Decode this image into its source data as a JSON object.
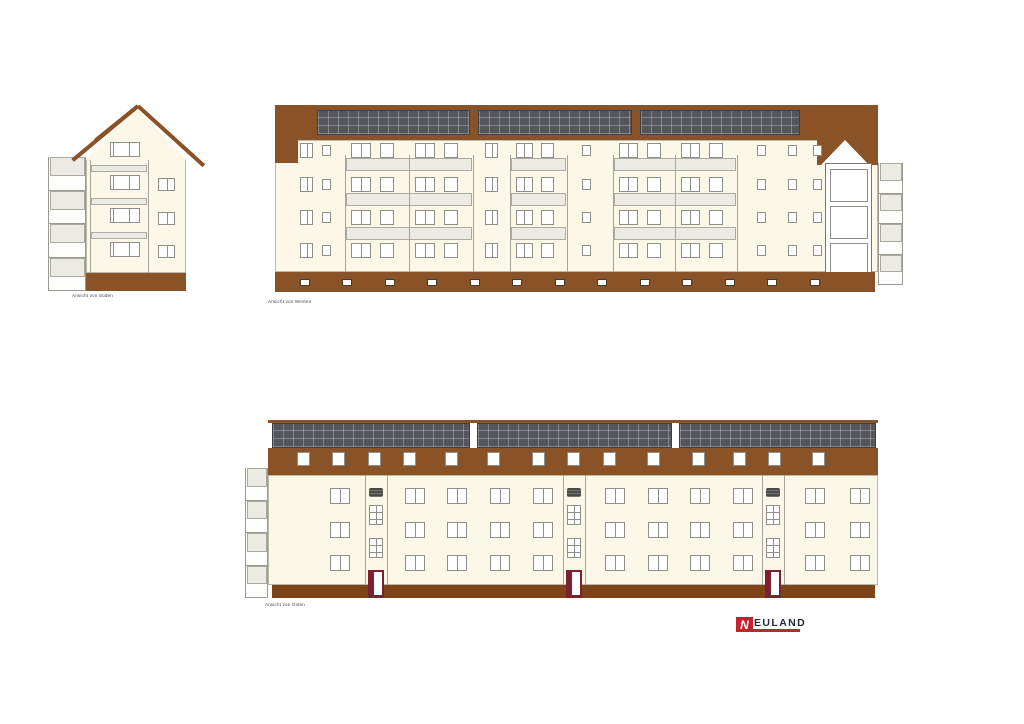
{
  "labels": {
    "south": "Ansicht von Süden",
    "west": "Ansicht von Westen",
    "east": "Ansicht von Osten"
  },
  "logo": {
    "mark": "N",
    "text": "EULAND"
  },
  "colors": {
    "roof_brown": "#8A5227",
    "base_brown_dark": "#7E4318",
    "facade_cream": "#FBF8E8",
    "solar_panel": "#55565C",
    "parapet_gray": "#EBEBE3",
    "window_frame": "#8F8F89",
    "door_red": "#7C2130",
    "logo_red": "#C2242E",
    "logo_text": "#252B36"
  },
  "drawing": {
    "south": {
      "balcony": {
        "x": 0,
        "y": 57,
        "w": 38,
        "h": 134,
        "levels": 4
      },
      "gable_tri": {
        "x": 38,
        "y": 6,
        "half": 50,
        "h": 54
      },
      "roof_bars": [
        {
          "x": 90,
          "y": 4,
          "len": 89,
          "ang": 42.2
        },
        {
          "x": 90,
          "y": 4,
          "len": 85,
          "ang": 140.3
        },
        {
          "x": 90,
          "y": 4,
          "len": 55,
          "ang": 141
        }
      ],
      "facade": {
        "x": 38,
        "y": 59,
        "w": 100,
        "h": 114
      },
      "loggia": {
        "x1": 42,
        "x2": 100,
        "top": 60,
        "bottom": 173,
        "bands": [
          65,
          98,
          132
        ],
        "band_h": 7
      },
      "center_windows": {
        "x": 62,
        "w": 30,
        "h": 15,
        "rows": [
          42,
          75,
          108,
          142
        ],
        "divider": 0.65
      },
      "side_windows": {
        "x": 110,
        "w": 17,
        "h": 13,
        "rows": [
          78,
          112,
          145
        ]
      },
      "base": {
        "x": 38,
        "y": 173,
        "w": 100,
        "h": 18
      }
    },
    "west": {
      "roof": {
        "x": 0,
        "y": 0,
        "w": 542,
        "h": 35
      },
      "left_block": {
        "x": 0,
        "y": 0,
        "w": 23,
        "h": 58
      },
      "gable_block": {
        "x": 542,
        "y": 0,
        "w": 61,
        "h": 60
      },
      "gable_tri": {
        "x": 546,
        "y": 35,
        "half": 24,
        "h": 25
      },
      "solar": [
        {
          "x": 42,
          "y": 5,
          "w": 153,
          "h": 25
        },
        {
          "x": 203,
          "y": 5,
          "w": 154,
          "h": 25
        },
        {
          "x": 365,
          "y": 5,
          "w": 160,
          "h": 25
        }
      ],
      "facade": {
        "x": 0,
        "y": 35,
        "w": 603,
        "h": 132
      },
      "rows": [
        38,
        72,
        105,
        138
      ],
      "wall_windows": {
        "big": {
          "w": 13,
          "h": 15,
          "xs": [
            25,
            210
          ]
        },
        "small": {
          "w": 9,
          "h": 11,
          "xs": [
            47,
            307,
            482,
            513,
            538
          ]
        }
      },
      "loggias": [
        {
          "x": 70,
          "w": 128,
          "bays": 2
        },
        {
          "x": 235,
          "w": 57,
          "bays": 1
        },
        {
          "x": 338,
          "w": 124,
          "bays": 2
        }
      ],
      "loggia_frame": {
        "top": 50,
        "bottom": 167,
        "band_ys": [
          53,
          88,
          122
        ],
        "band_h": 13
      },
      "tower": {
        "x": 550,
        "y": 58,
        "w": 47,
        "h": 119,
        "win_ys": [
          63,
          100,
          137
        ],
        "win_h": 33
      },
      "balcony": {
        "x": 603,
        "y": 58,
        "w": 25,
        "h": 122,
        "levels": 4
      },
      "base": {
        "x": 0,
        "y": 167,
        "w": 600,
        "h": 20
      },
      "vents": {
        "y": 174,
        "w": 10,
        "h": 7,
        "xs": [
          25,
          67,
          110,
          152,
          195,
          237,
          280,
          322,
          365,
          407,
          450,
          492,
          535
        ]
      }
    },
    "east": {
      "balcony": {
        "x": 0,
        "y": 48,
        "w": 23,
        "h": 130,
        "levels": 4
      },
      "ridge": {
        "x": 23,
        "y": 0,
        "w": 610,
        "h": 3
      },
      "solar": [
        {
          "x": 27,
          "y": 3,
          "w": 198,
          "h": 25
        },
        {
          "x": 232,
          "y": 3,
          "w": 195,
          "h": 25
        },
        {
          "x": 434,
          "y": 3,
          "w": 197,
          "h": 25
        }
      ],
      "band": {
        "x": 23,
        "y": 28,
        "w": 610,
        "h": 27
      },
      "dormers": {
        "y": 32,
        "w": 13,
        "h": 14,
        "xs": [
          52,
          87,
          123,
          158,
          200,
          242,
          287,
          322,
          358,
          402,
          447,
          488,
          523,
          567
        ]
      },
      "facade": {
        "x": 23,
        "y": 55,
        "w": 610,
        "h": 110
      },
      "rows": [
        68,
        102,
        135
      ],
      "win": {
        "w": 20,
        "h": 16
      },
      "cols": [
        85,
        160,
        202,
        245,
        288,
        360,
        403,
        445,
        488,
        560,
        605
      ],
      "stairwells": {
        "w": 22,
        "xs": [
          120,
          318,
          517
        ],
        "grille_y": 68,
        "grille_h": 9,
        "win_ys": [
          85,
          118
        ],
        "win_h": 20,
        "door_y": 150,
        "door_h": 28
      },
      "base": {
        "x": 27,
        "y": 165,
        "w": 603,
        "h": 13
      }
    }
  }
}
